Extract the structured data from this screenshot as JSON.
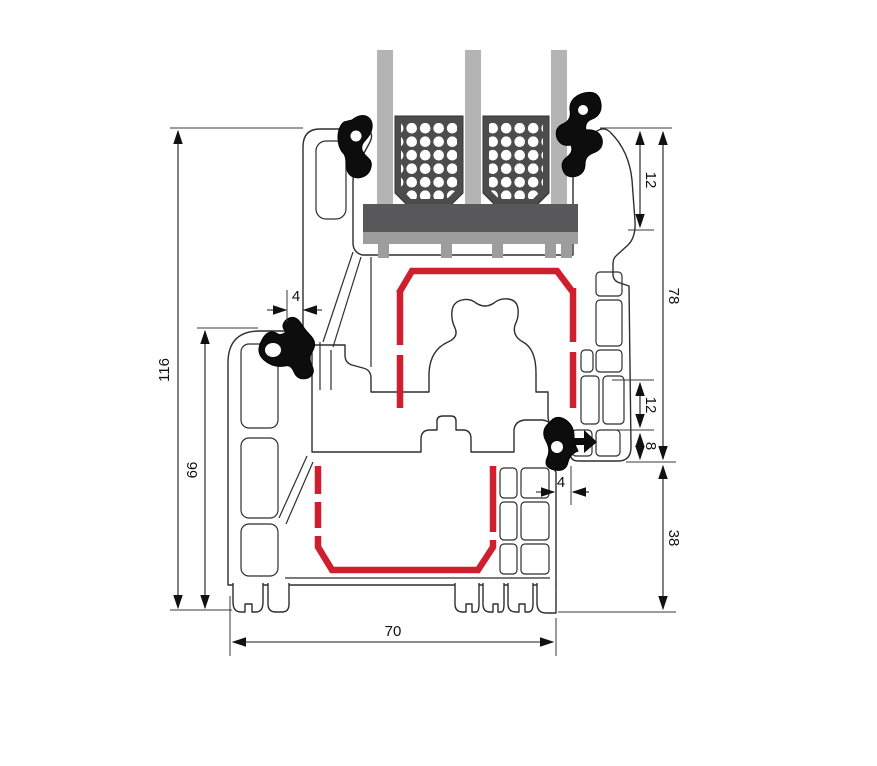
{
  "diagram": {
    "dimensions": {
      "total_height": "116",
      "frame_height": "66",
      "glazing_depth": "12",
      "sash_height": "78",
      "rebate_mid": "12",
      "overlap": "8",
      "frame_bottom_height": "38",
      "profile_width": "70",
      "gap_top": "4",
      "gap_bottom": "4"
    },
    "colors": {
      "steel_red": "#cf1f2e",
      "glass_gray": "#b4b4b4",
      "spacer_dark": "#4c4c4c",
      "block_dark": "#58585a",
      "bridge_gray": "#9d9d9d",
      "gasket_black": "#0d0d0d"
    }
  }
}
